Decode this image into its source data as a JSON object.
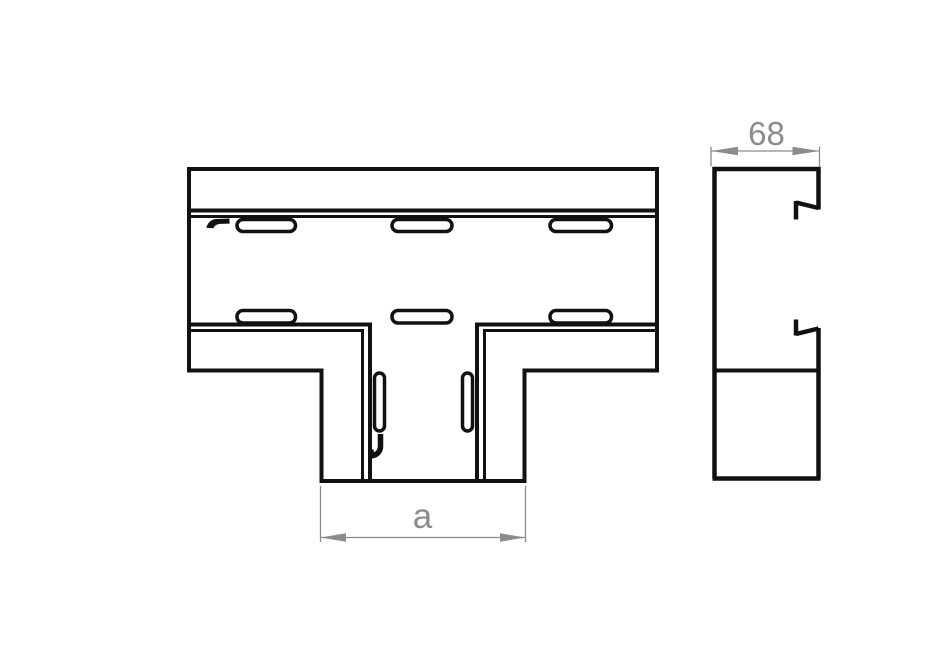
{
  "page": {
    "background": "#ffffff"
  },
  "drawing": {
    "type": "technical-line-drawing",
    "subject": "cable-trunking-tee-piece",
    "line_color": "#111111",
    "dimension_color": "#8c8c8c",
    "dimensions": {
      "profile_width": {
        "label": "68"
      },
      "branch_width": {
        "label": "a"
      }
    }
  }
}
